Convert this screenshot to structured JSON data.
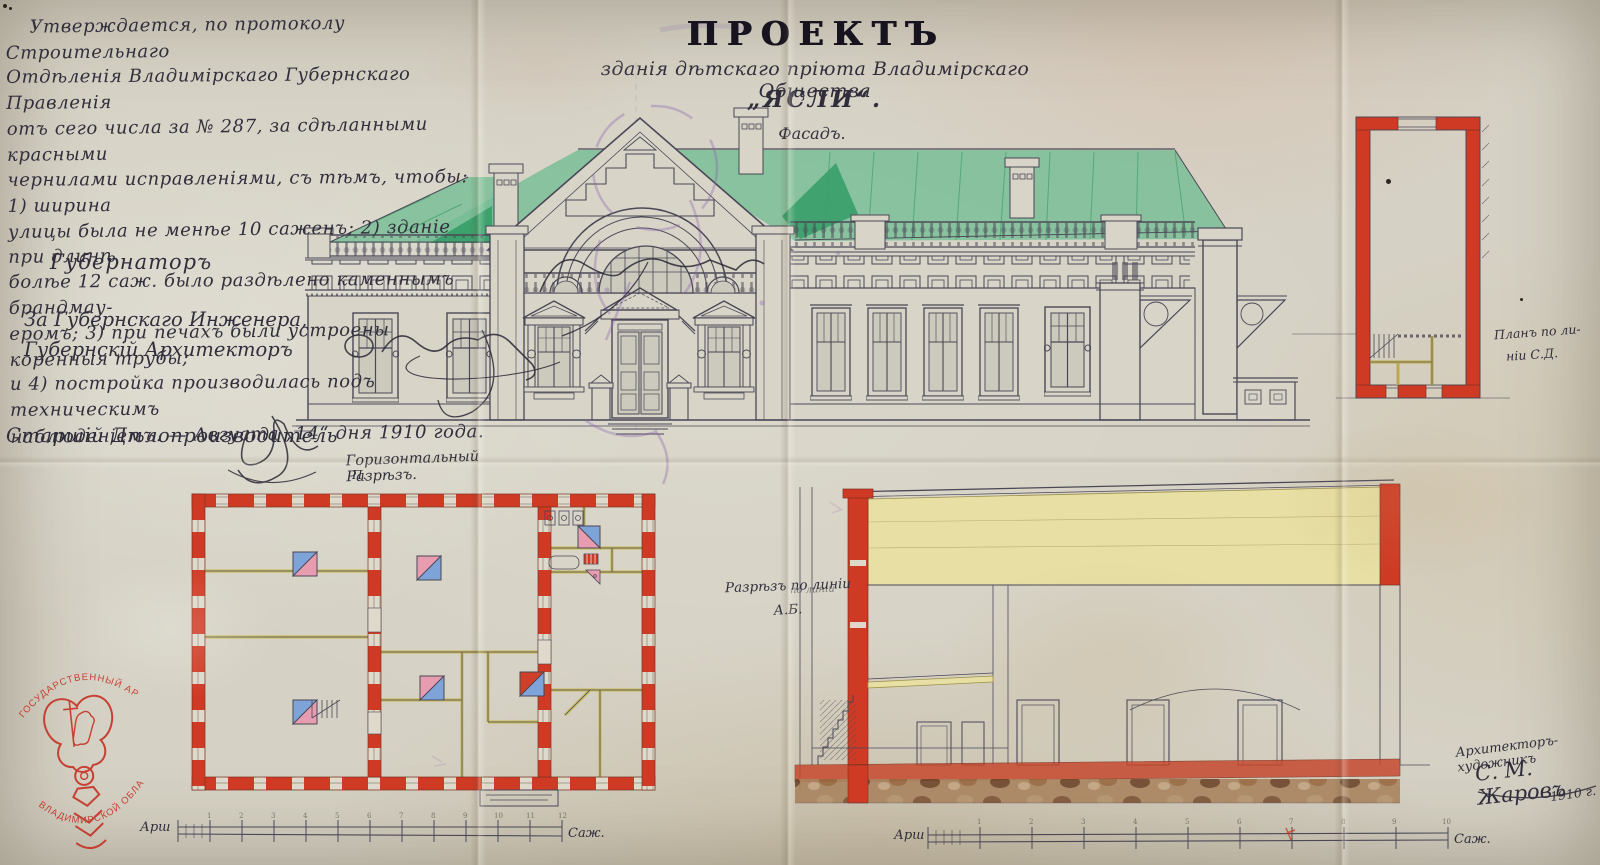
{
  "palette": {
    "paper": "#d5d1c4",
    "ink": "#4a4857",
    "handwriting_ink": "#312e3c",
    "wall_red": "#cf3a24",
    "roof_green": "#74bd93",
    "roof_green_dark": "#2e9a63",
    "wood_yellow": "#e7dfa4",
    "stamp_red": "#c4291b",
    "ghost_purple": "#8a62b0"
  },
  "approval": {
    "lines": [
      "Утверждается, по протоколу Строительнаго",
      "Отдѣленія Владимірскаго Губернскаго Правленія",
      "отъ сего числа за № 287, за сдѣланными красными",
      "чернилами исправленіями, съ тѣмъ, чтобы: 1) ширина",
      "улицы была не менѣе 10 саженъ; 2) зданіе при длинѣ",
      "болѣе 12 саж. было раздѣлено каменнымъ брандмау-",
      "еромъ; 3) при печахъ были устроены коренныя трубы;",
      "и 4) постройка производилась подъ техническимъ",
      "наблюденіемъ. — Августа „14“ дня 1910 года."
    ]
  },
  "title": {
    "main": "ПРОЕКТЪ",
    "subtitle": "зданія дѣтскаго пріюта Владимірскаго Общества",
    "name": "„ЯСЛИ“."
  },
  "labels": {
    "facade": "Фасадъ.",
    "plan": "Горизонтальный Разрѣзъ.",
    "plan_sub": "П.",
    "section_1": "Разрѣзъ по линіи",
    "section_2": "А.Б.",
    "section_note": "по линіи",
    "side_plan_1": "Планъ по ли-",
    "side_plan_2": "ніи С.Д."
  },
  "signatures": {
    "governor": "Губернаторъ",
    "engineer_1": "За Губернскаго Инженера,",
    "engineer_2": "Губернскій Архитекторъ",
    "clerk": "Старшій Дѣлопроизводитель"
  },
  "credit": {
    "role": "Архитекторъ-художникъ",
    "name": "С. М. Жаровъ",
    "year": "1910 г."
  },
  "stamp": {
    "arc_top": "ГОСУДАРСТВЕННЫЙ АРХИВ",
    "arc_bottom": "ВЛАДИМИРСКОЙ ОБЛАСТИ"
  },
  "scale_left": {
    "start": "Арш",
    "end": "Саж.",
    "ticks": [
      "1",
      "2",
      "3",
      "4",
      "5",
      "6",
      "7",
      "8",
      "9",
      "10",
      "11",
      "12"
    ]
  },
  "scale_right": {
    "start": "Арш",
    "end": "Саж.",
    "ticks": [
      "1",
      "2",
      "3",
      "4",
      "5",
      "6",
      "7",
      "8",
      "9",
      "10"
    ]
  }
}
